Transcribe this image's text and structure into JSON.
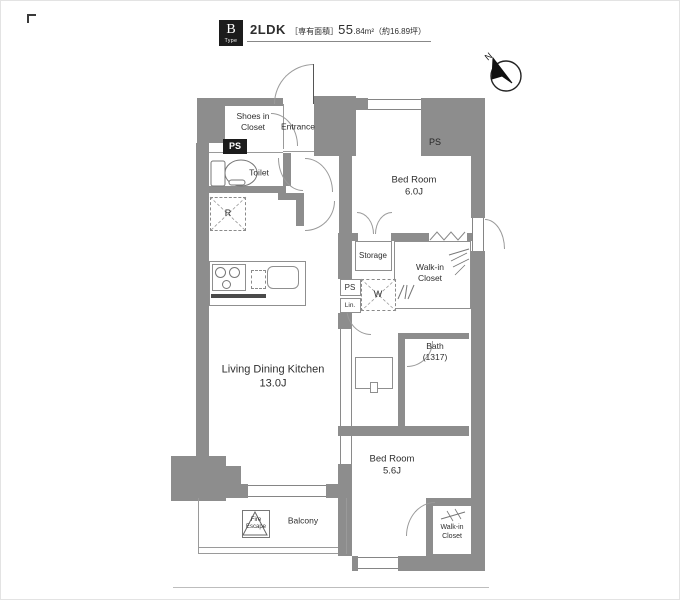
{
  "header": {
    "logo_letter": "B",
    "logo_word": "Type",
    "layout": "2LDK",
    "area_bracket": "［専有面積］",
    "area_int": "55",
    "area_frac": ".84m²",
    "area_tsubo": "（約16.89坪）"
  },
  "compass": {
    "north": "N"
  },
  "labels": {
    "shoes1": "Shoes in",
    "shoes2": "Closet",
    "entrance": "Entrance",
    "ps_entry": "PS",
    "toilet": "Toilet",
    "fridge": "R",
    "bed1_name": "Bed Room",
    "bed1_size": "6.0J",
    "ps_bed": "PS",
    "storage": "Storage",
    "wic1_1": "Walk-in",
    "wic1_2": "Closet",
    "ps_mid": "PS",
    "linen": "Lin.",
    "washer": "W",
    "bath_name": "Bath",
    "bath_size": "(1317)",
    "ldk_name": "Living Dining Kitchen",
    "ldk_size": "13.0J",
    "bed2_name": "Bed Room",
    "bed2_size": "5.6J",
    "balcony": "Balcony",
    "fire1": "Fire",
    "fire2": "Escape",
    "wic2_1": "Walk-in",
    "wic2_2": "Closet"
  },
  "colors": {
    "wall": "#8d8d8d",
    "accent_black": "#1c1c1c",
    "line": "#9a9a9a",
    "text": "#2e2e2e"
  }
}
